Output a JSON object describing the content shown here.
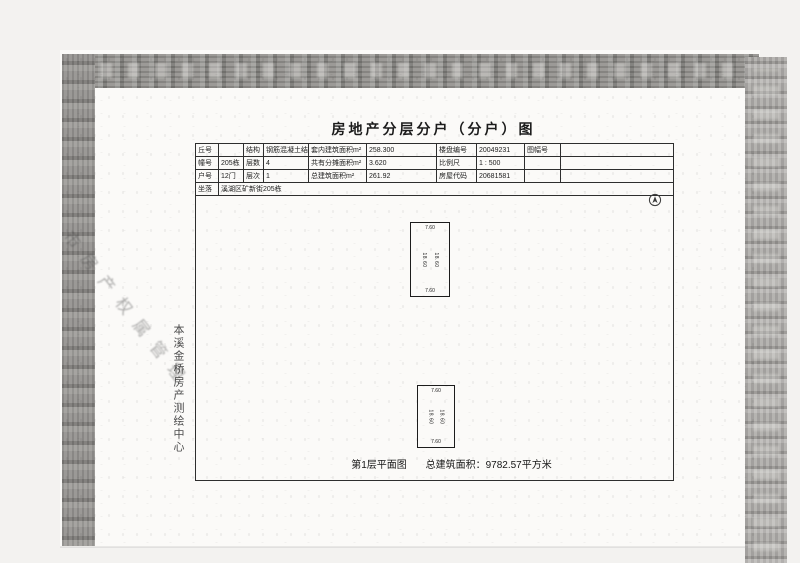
{
  "doc": {
    "title": "房地产分层分户（分户）图",
    "table": {
      "r0": [
        "丘号",
        "",
        "结构",
        "钢筋混凝土结构",
        "套内建筑面积m²",
        "258.300",
        "楼盘编号",
        "20049231",
        "图幅号",
        ""
      ],
      "r1": [
        "幢号",
        "205栋",
        "层数",
        "4",
        "共有分摊面积m²",
        "3.620",
        "比例尺",
        "1 : 500",
        "",
        ""
      ],
      "r2": [
        "户号",
        "12门",
        "层次",
        "1",
        "总建筑面积m²",
        "261.92",
        "房屋代码",
        "20681581",
        "",
        ""
      ],
      "r3_label": "坐落",
      "r3_value": "溪湖区矿新街205栋"
    },
    "plan": {
      "unit1": {
        "top": "7.60",
        "bottom": "7.60",
        "left_dim": "18.60",
        "right_dim": "18.60"
      },
      "unit2": {
        "top": "7.60",
        "bottom": "7.60",
        "left_dim": "18.60",
        "right_dim": "18.60"
      },
      "caption_left": "第1层平面图",
      "caption_right": "总建筑面积：9782.57平方米"
    },
    "stamps": {
      "vertical": "本溪金桥房产测绘中心",
      "diagonal": "市房产权属管理"
    },
    "icons": {
      "north_arrow": "north-arrow-icon"
    },
    "colors": {
      "paper": "#fbfaf8",
      "ink": "#1d1d1d",
      "scan_band": "#8e8c89"
    }
  }
}
